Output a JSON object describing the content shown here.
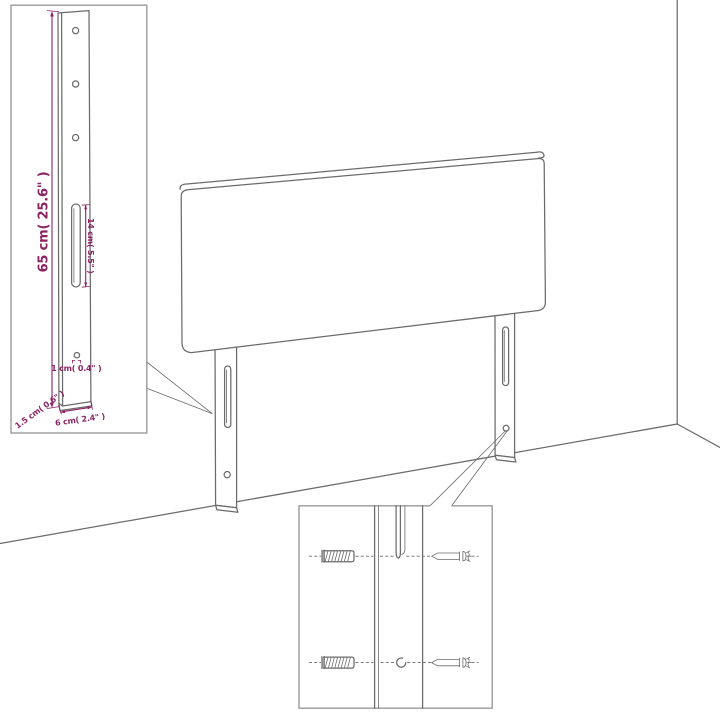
{
  "colors": {
    "background": "#ffffff",
    "line_gray": "#6b6b6b",
    "border_gray": "#9a9a9a",
    "dimension_magenta": "#8c2464"
  },
  "leg_detail_inset": {
    "labels": {
      "leg_height": "65 cm( 25.6\" )",
      "slot_length": "14 cm( 5.5\" )",
      "hole_diameter": "1 cm( 0.4\" )",
      "leg_thickness": "1.5 cm( 0.6\" )",
      "leg_width": "6 cm( 2.4\" )"
    },
    "icons": [
      "mounting-leg-side-view",
      "screw-hole",
      "long-slot",
      "small-hole"
    ]
  },
  "main_view": {
    "icons": [
      "headboard-panel",
      "left-mounting-leg",
      "right-mounting-leg",
      "wall-corner",
      "floor-line"
    ]
  },
  "hardware_detail_inset": {
    "icons": [
      "wall-plug",
      "screw",
      "mounting-slot",
      "mounting-hole"
    ]
  }
}
